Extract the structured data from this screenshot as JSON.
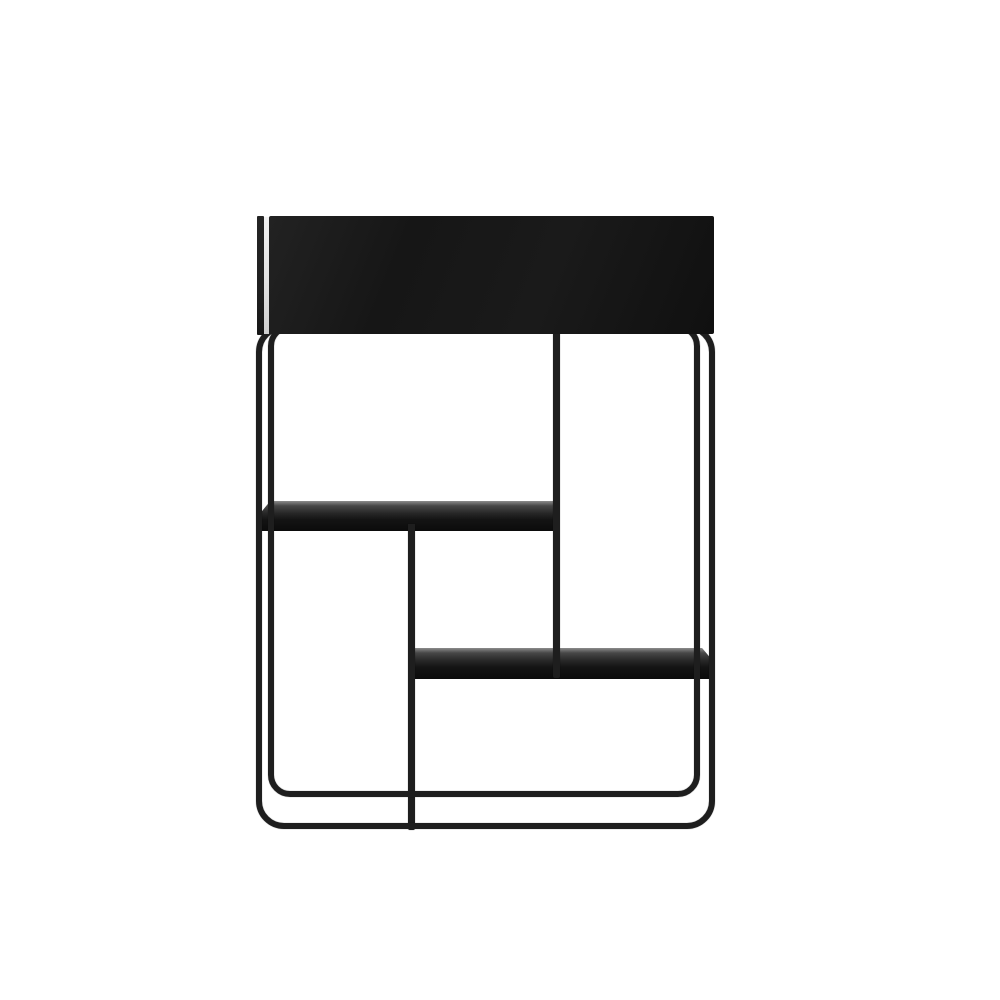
{
  "meta": {
    "type": "product-photo",
    "subject": "Black metal plant-box console table with tubular wire frame and two staggered shelves",
    "background": "plain white studio background",
    "visible_text": "none"
  },
  "colors": {
    "background": "#ffffff",
    "metal_frame": "#1e1e1e",
    "box_front": "#161616",
    "box_side_edge": "#202020",
    "edge_highlight": "#e2e2e2",
    "shelf_top_highlight": "#8c8c8c",
    "shelf_body": "#141414"
  },
  "product": {
    "parts": [
      {
        "name": "planter-box-top",
        "description": "Solid rectangular black box forming the top of the unit"
      },
      {
        "name": "box-side-edge",
        "description": "Thin dark side panel edge visible at the left of the box"
      },
      {
        "name": "box-gap-highlight",
        "description": "Light highlight seam between side edge and box front face"
      },
      {
        "name": "outer-frame",
        "description": "Front tubular steel frame with rounded corners reaching the floor"
      },
      {
        "name": "inner-frame",
        "description": "Rear tubular steel frame, slightly smaller, seen in perspective"
      },
      {
        "name": "center-post",
        "description": "Vertical tube from box underside down to the lower shelf"
      },
      {
        "name": "divider-post",
        "description": "Vertical tube from the upper shelf down to the base"
      },
      {
        "name": "upper-shelf",
        "description": "Left-side metal shelf spanning from left frame to center post"
      },
      {
        "name": "lower-shelf",
        "description": "Right-side metal shelf spanning from divider post to right frame"
      }
    ]
  }
}
